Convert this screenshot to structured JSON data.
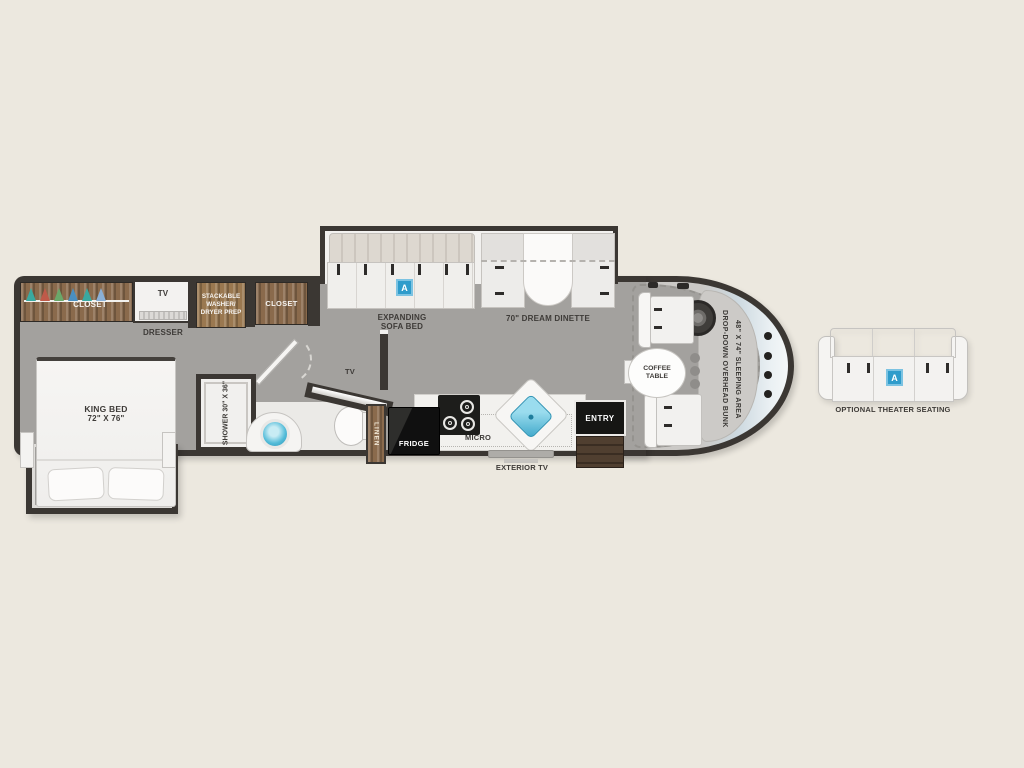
{
  "colors": {
    "background": "#ece8df",
    "wall": "#3b3733",
    "floor": "#a3a19e",
    "wood": "#8a6a4c",
    "accent_blue": "#2f9ccb",
    "sink_blue": "#45b4d6",
    "windshield": "#dce6ec",
    "fixture_black": "#161614"
  },
  "bedroom": {
    "closet": "CLOSET",
    "tv": "TV",
    "dresser": "DRESSER",
    "washer_lines": [
      "STACKABLE",
      "WASHER/",
      "DRYER PREP"
    ],
    "hall_closet": "CLOSET",
    "bed_name": "KING BED",
    "bed_size": "72\" X 76\""
  },
  "bath": {
    "shower_name": "SHOWER",
    "shower_size": "30\" X 36\"",
    "tv": "TV",
    "linen": "LINEN"
  },
  "living": {
    "sofa_lines": [
      "EXPANDING",
      "SOFA BED"
    ],
    "sofa_marker": "A",
    "dinette": "70\" DREAM DINETTE"
  },
  "kitchen": {
    "fridge": "FRIDGE",
    "micro": "MICRO",
    "exterior_tv": "EXTERIOR TV",
    "entry": "ENTRY"
  },
  "cab": {
    "coffee_lines": [
      "COFFEE",
      "TABLE"
    ],
    "bunk_line1": "DROP-DOWN OVERHEAD BUNK",
    "bunk_line2": "48\" X 74\" SLEEPING AREA"
  },
  "theater": {
    "marker": "A",
    "label": "OPTIONAL THEATER SEATING"
  }
}
